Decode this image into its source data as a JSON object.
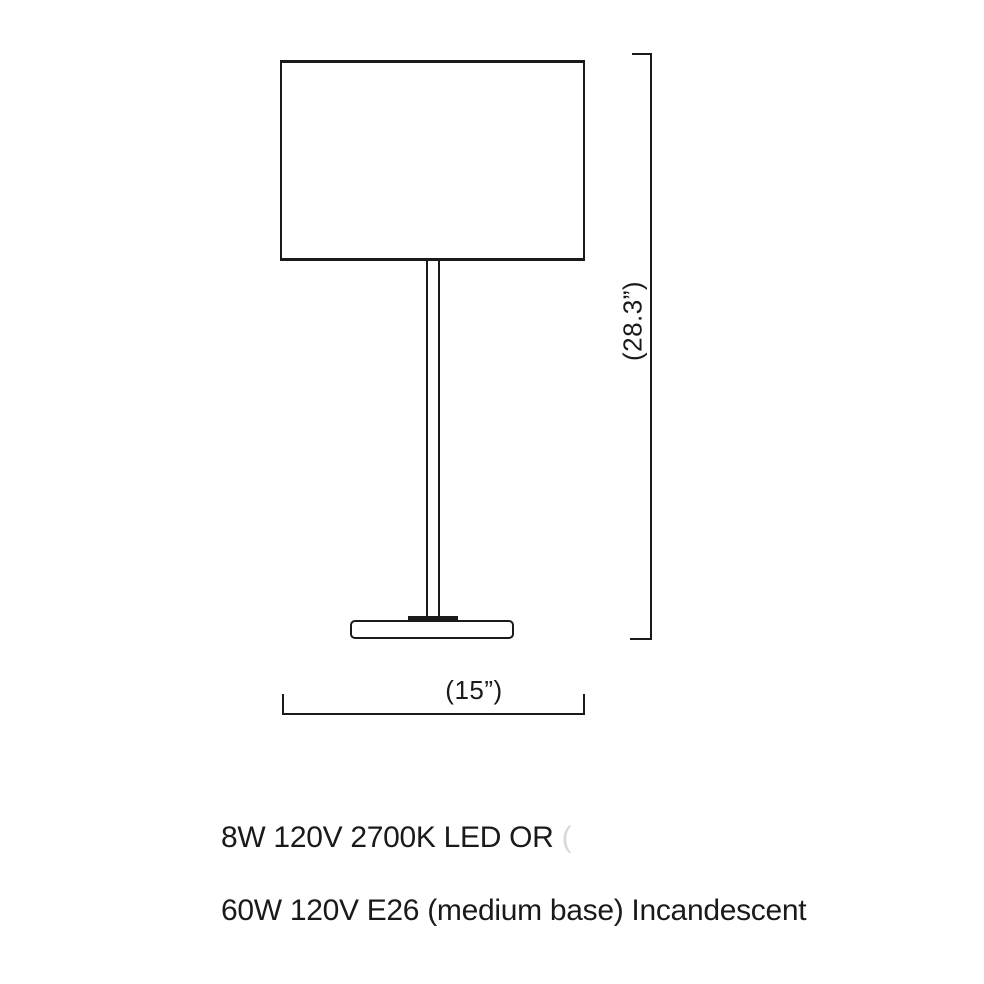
{
  "diagram": {
    "title": "table lamp dimension drawing",
    "height_label": "(28.3”)",
    "width_label": "(15”)",
    "height_in": 28.3,
    "width_in": 15
  },
  "specs": {
    "line1": "8W 120V 2700K LED OR",
    "line1_trailing_faint": "(",
    "line2": "60W 120V E26 (medium base) Incandescent"
  },
  "colors": {
    "line": "#1a1a1a",
    "text": "#1a1a1a",
    "faint_text": "#d8d8d8",
    "background": "#ffffff"
  }
}
